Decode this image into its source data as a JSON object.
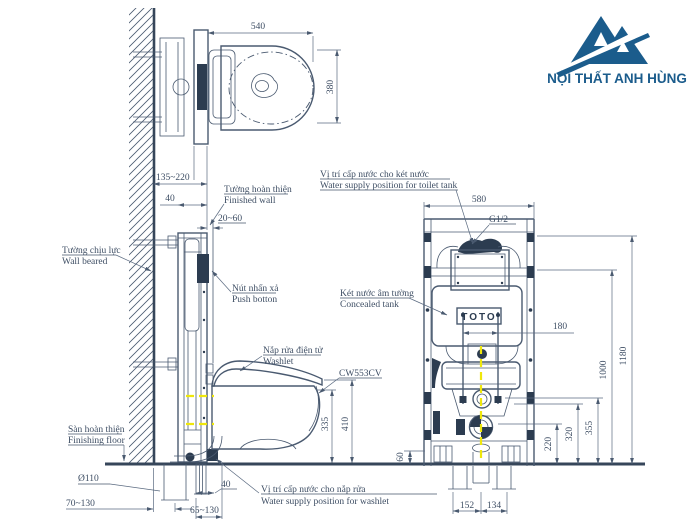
{
  "logo": {
    "title": "NỘI THẤT ANH HÙNG",
    "color": "#1b5c8c"
  },
  "brand": "TOTO",
  "model": "CW553CV",
  "thread": "G1/2",
  "dims": {
    "top_width": "540",
    "top_depth": "380",
    "wall_clearance": "135~220",
    "rail_depth": "40",
    "finish_thickness": "20~60",
    "bowl_height": "335",
    "lid_height": "410",
    "drain_dia": "Ø110",
    "drain_offset": "70~130",
    "supply_offset": "40",
    "supply_range": "65~130",
    "frame_width": "580",
    "bolt_spacing": "180",
    "foot_height": "60",
    "h220": "220",
    "h320": "320",
    "h355": "355",
    "h1000": "1000",
    "h1180": "1180",
    "pipe_152": "152",
    "pipe_134": "134"
  },
  "labels": {
    "finished_wall": {
      "vi": "Tường hoàn thiện",
      "en": "Finished wall"
    },
    "wall_beared": {
      "vi": "Tường chịu lực",
      "en": "Wall beared"
    },
    "push_button": {
      "vi": "Nút nhấn xả",
      "en": "Push botton"
    },
    "washlet": {
      "vi": "Nắp rửa điện tử",
      "en": "Washlet"
    },
    "finishing_floor": {
      "vi": "Sàn hoàn thiện",
      "en": "Finishing floor"
    },
    "washlet_supply": {
      "vi": "Vị trí cấp nước cho nắp rửa",
      "en": "Water supply position for washlet"
    },
    "tank_supply": {
      "vi": "Vị trí cấp nước cho két nước",
      "en": "Water supply position for toilet tank"
    },
    "concealed_tank": {
      "vi": "Két nước âm tường",
      "en": "Concealed tank"
    }
  }
}
